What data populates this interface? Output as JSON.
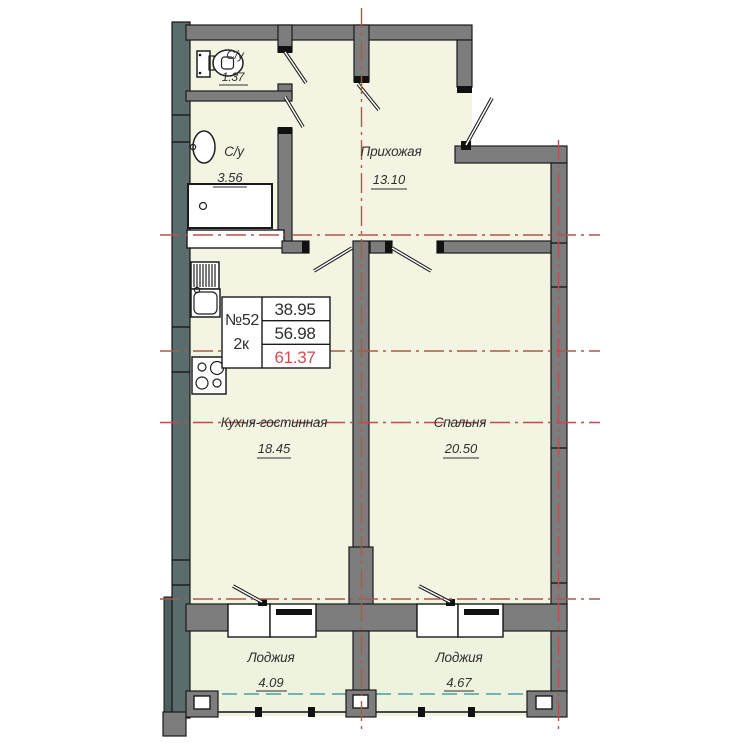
{
  "unit_card": {
    "number": "№52",
    "layout": "2к",
    "living_area": "38.95",
    "area_without_loggia": "56.98",
    "total_area": "61.37"
  },
  "rooms": {
    "wc": {
      "label": "С/у",
      "area": "1.37"
    },
    "bathroom": {
      "label": "С/у",
      "area": "3.56"
    },
    "hallway": {
      "label": "Прихожая",
      "area": "13.10"
    },
    "kitchen_living": {
      "label": "Кухня-гостинная",
      "area": "18.45"
    },
    "bedroom": {
      "label": "Спальня",
      "area": "20.50"
    },
    "loggia_left": {
      "label": "Лоджия",
      "area": "4.09"
    },
    "loggia_right": {
      "label": "Лоджия",
      "area": "4.67"
    }
  },
  "colors": {
    "room_fill": "#f3f5e2",
    "loggia_fill": "#eef3df",
    "wall": "#7d7d7d",
    "exterior_wall": "#5a6c6c",
    "axis_red": "#b2544c",
    "total_area_accent": "#d05050",
    "loggia_glazing_teal": "#4f9e9e",
    "outline": "#1a1a1a"
  }
}
